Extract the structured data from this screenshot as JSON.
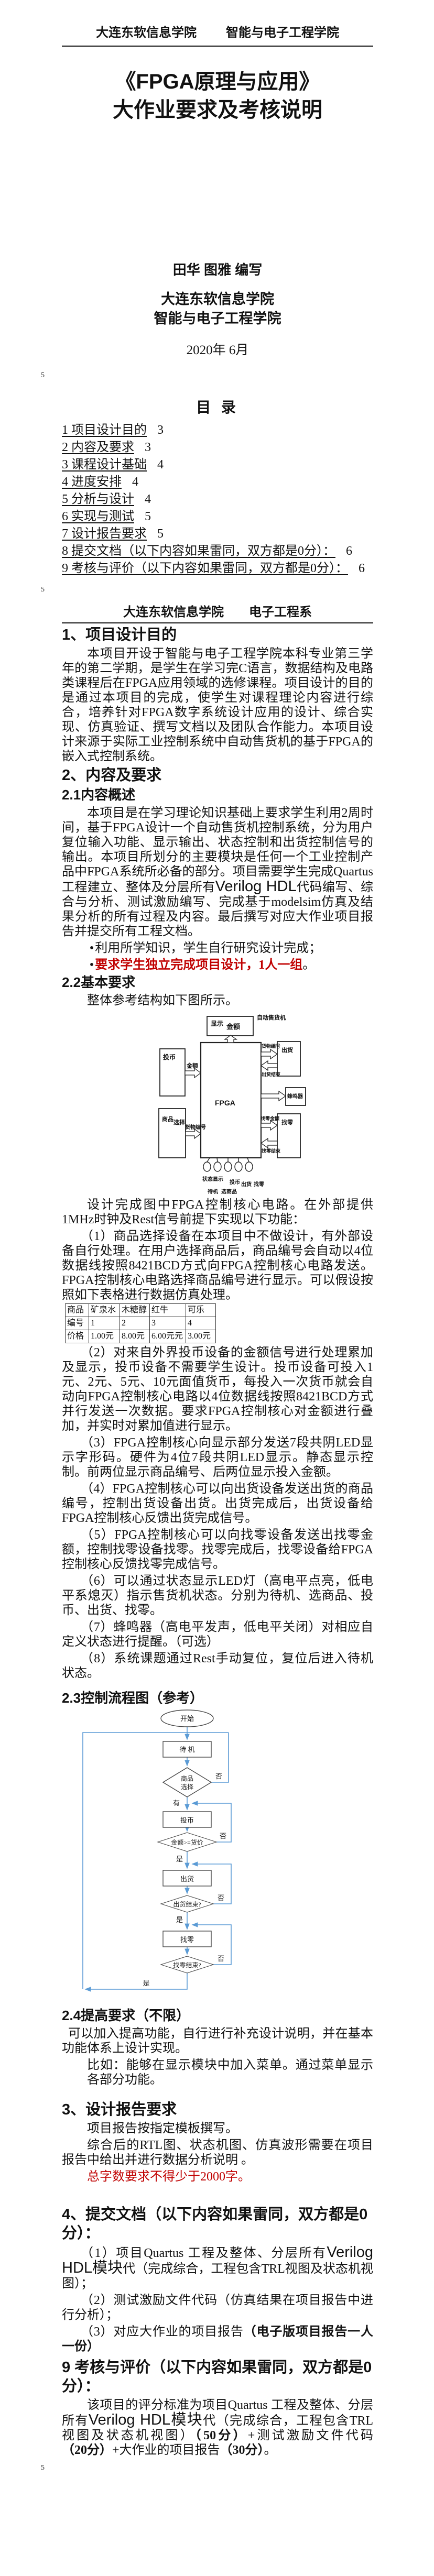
{
  "colors": {
    "accent_red": "#c00000",
    "flowchart_blue": "#5b9bd5"
  },
  "misc": {
    "bullet": "•"
  },
  "header": {
    "left": "大连东软信息学院",
    "right": "智能与电子工程学院"
  },
  "title": {
    "line1": "《FPGA原理与应用》",
    "line2": "大作业要求及考核说明"
  },
  "cover": {
    "authors": "田华 图雅 编写",
    "org1": "大连东软信息学院",
    "org2": "智能与电子工程学院",
    "date": "2020年 6月"
  },
  "page_markers": {
    "m1": "5",
    "m2": "5",
    "m3": "5"
  },
  "toc": {
    "title": "目  录",
    "items": [
      {
        "label": "1 项目设计目的",
        "page": "3"
      },
      {
        "label": "2 内容及要求",
        "page": "3"
      },
      {
        "label": "3 课程设计基础",
        "page": "4"
      },
      {
        "label": "4 进度安排",
        "page": "4"
      },
      {
        "label": "5 分析与设计",
        "page": "4"
      },
      {
        "label": "6 实现与测试",
        "page": "5"
      },
      {
        "label": "7 设计报告要求",
        "page": "5"
      },
      {
        "label": "8 提交文档（以下内容如果雷同，双方都是0分）：",
        "page": "6"
      },
      {
        "label": "9 考核与评价（以下内容如果雷同，双方都是0分）：",
        "page": "6"
      }
    ]
  },
  "page2": {
    "header_left": "大连东软信息学院",
    "header_right": "电子工程系"
  },
  "s1": {
    "h": "1、项目设计目的",
    "body": "本项目开设于智能与电子工程学院本科专业第三学年的第二学期，是学生在学习完C语言，数据结构及电路类课程后在FPGA应用领域的选修课程。项目设计的目的是通过本项目的完成，使学生对课程理论内容进行综合，培养针对FPGA数字系统设计应用的设计、综合实现、仿真验证、撰写文档以及团队合作能力。本项目设计来源于实际工业控制系统中自动售货机的基于FPGA的嵌入式控制系统。"
  },
  "s2": {
    "h": "2、内容及要求"
  },
  "s21": {
    "h": "2.1内容概述",
    "p1a": "本项目是在学习理论知识基础上要求学生利用2周时间，基于FPGA设计一个自动售货机控制系统，分为用户复位输入功能、显示输出、状态控制和出货控制信号的输出。本项目所划分的主要模块是任何一个工业控制产品中FPGA系统所必备的部分。项目需要学生完成Quartus 工程建立、整体及分层所有",
    "p1b": "Verilog HDL",
    "p1c": "代码编写、综合与分析、测试激励编写、完成基于modelsim仿真及结果分析的所有过程及内容。最后撰写对应大作业项目报告并提交所有工程文档。",
    "b1": "利用所学知识，学生自行研究设计完成；",
    "b2_red": "要求学生独立完成项目设计，1人一组",
    "b2_tail": "。"
  },
  "s22": {
    "h": "2.2基本要求",
    "p": "整体参考结构如下图所示。"
  },
  "diagram": {
    "system": "自动售货机",
    "display1": "显示",
    "display2": "金额",
    "fpga": "FPGA",
    "coin": "投币",
    "amount": "金额",
    "goods1": "商品",
    "goods2": "选择",
    "goods_no": "货物编号",
    "ship": "出货",
    "ship_done": "出货结束",
    "buzzer": "蜂鸣器",
    "change": "找零",
    "change_amount": "找零金额",
    "change_done": "找零结束",
    "pin_status": "状态显示",
    "pin_coin": "投币",
    "pin_ship": "出货",
    "pin_change": "找零",
    "pin_standby": "待机",
    "pin_pick": "选商品"
  },
  "s22_intro": {
    "p1": "设计完成图中FPGA控制核心电路。在外部提供1MHz时钟及Rest信号前提下实现以下功能：",
    "p2": "（1）商品选择设备在本项目中不做设计，有外部设备自行处理。在用户选择商品后，商品编号会自动以4位数据线按照8421BCD方式向FPGA控制核心电路发送。FPGA控制核心电路选择商品编号进行显示。可以假设按照如下表格进行数据仿真处理。"
  },
  "table": {
    "rows": [
      [
        "商品",
        "矿泉水",
        "木糖醇",
        "红牛",
        "可乐"
      ],
      [
        "编号",
        "1",
        "2",
        "3",
        "4"
      ],
      [
        "价格",
        "1.00元",
        "8.00元",
        "6.00元元",
        "3.00元"
      ]
    ]
  },
  "reqs": {
    "p2": "（2）对来自外界投币设备的金额信号进行处理累加及显示，投币设备不需要学生设计。投币设备可投入1元、2元、5元、10元面值货币，每投入一次货币就会自动向FPGA控制核心电路以4位数据线按照8421BCD方式并行发送一次数据。要求FPGA控制核心对金额进行叠加，并实时对累加值进行显示。",
    "p3": "（3）FPGA控制核心向显示部分发送7段共阴LED显示字形码。硬件为4位7段共阴LED显示。静态显示控制。前两位显示商品编号、后两位显示投入金额。",
    "p4": "（4）FPGA控制核心可以向出货设备发送出货的商品编号，控制出货设备出货。出货完成后，出货设备给FPGA控制核心反馈出货完成信号。",
    "p5": "（5）FPGA控制核心可以向找零设备发送出找零金额，控制找零设备找零。找零完成后，找零设备给FPGA控制核心反馈找零完成信号。",
    "p6": "（6）可以通过状态显示LED灯（高电平点亮，低电平系熄灭）指示售货机状态。分别为待机、选商品、投币、出货、找零。",
    "p7": "（7）蜂鸣器（高电平发声，低电平关闭）对相应自定义状态进行提醒。（可选）",
    "p8": "（8）系统课题通过Rest手动复位，复位后进入待机状态。"
  },
  "s23": {
    "h": "2.3控制流程图（参考）"
  },
  "flowchart": {
    "start": "开始",
    "standby": "待  机",
    "select1": "商品",
    "select2": "选择",
    "no": "否",
    "yes_has": "有",
    "coin": "投币",
    "cond_amount": "金额>=货价",
    "yes": "是",
    "ship": "出货",
    "cond_ship": "出货结束?",
    "change": "找零",
    "cond_change": "找零结束?"
  },
  "s24": {
    "h": "2.4提高要求（不限）",
    "p1": "可以加入提高功能，自行进行补充设计说明，并在基本功能体系上设计实现。",
    "p2": "比如：能够在显示模块中加入菜单。通过菜单显示各部分功能。"
  },
  "s3": {
    "h": "3、设计报告要求",
    "p1": "项目报告按指定模板撰写。",
    "p2": "综合后的RTL图、状态机图、仿真波形需要在项目报告中给出并进行数据分析说明 。",
    "p3_red": "总字数要求不得少于2000字。"
  },
  "s4": {
    "h": "4、提交文档（以下内容如果雷同，双方都是0分）：",
    "i1a": "（1）项目Quartus 工程及整体、分层所有",
    "i1b": "Verilog HDL模块",
    "i1c": "代（完成综合，工程包含TRL视图及状态机视图）；",
    "i2": "（2）测试激励文件代码（仿真结果在项目报告中进行分析）；",
    "i3a": "（3）对应大作业的项目报告",
    "i3b": "（电子版项目报告一人一份）"
  },
  "s9": {
    "h": "9 考核与评价（以下内容如果雷同，双方都是0分）：",
    "pa": "该项目的评分标准为项目Quartus 工程及整体、分层所有",
    "pb": "Verilog HDL模块",
    "pc": "代（完成综合，工程包含TRL视图及状态机视图）",
    "pd": "（50分）",
    "pe": "+测试激励文件代码",
    "pf": "（20分）",
    "pg": "+大作业的项目报告",
    "ph": "（30分）",
    "pi": "。"
  }
}
